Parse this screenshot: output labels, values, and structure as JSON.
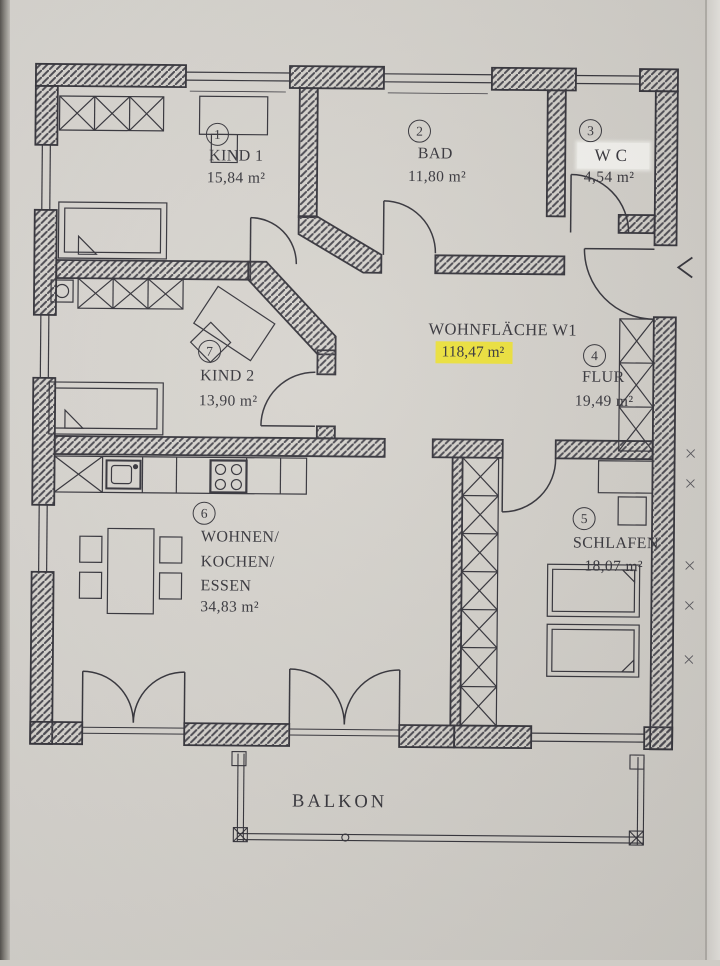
{
  "rooms": [
    {
      "number": "1",
      "name": "KIND 1",
      "area": "15,84 m²"
    },
    {
      "number": "2",
      "name": "BAD",
      "area": "11,80 m²"
    },
    {
      "number": "3",
      "name": "WC",
      "area": "4,54 m²"
    },
    {
      "number": "4",
      "name": "FLUR",
      "area": "19,49 m²"
    },
    {
      "number": "5",
      "name": "SCHLAFEN",
      "area": "18,07 m²"
    },
    {
      "number": "6",
      "name_lines": [
        "WOHNEN/",
        "KOCHEN/",
        "ESSEN"
      ],
      "area": "34,83 m²"
    },
    {
      "number": "7",
      "name": "KIND 2",
      "area": "13,90 m²"
    }
  ],
  "total_area": {
    "label": "WOHNFLÄCHE W1",
    "value": "118,47 m²",
    "highlight_color": "#ece13c"
  },
  "balcony": {
    "label": "BALKON"
  },
  "colors": {
    "paper": "#d6d3cd",
    "ink": "#36353b",
    "highlight": "#ece13c",
    "whiteout": "#f3f2ee"
  }
}
